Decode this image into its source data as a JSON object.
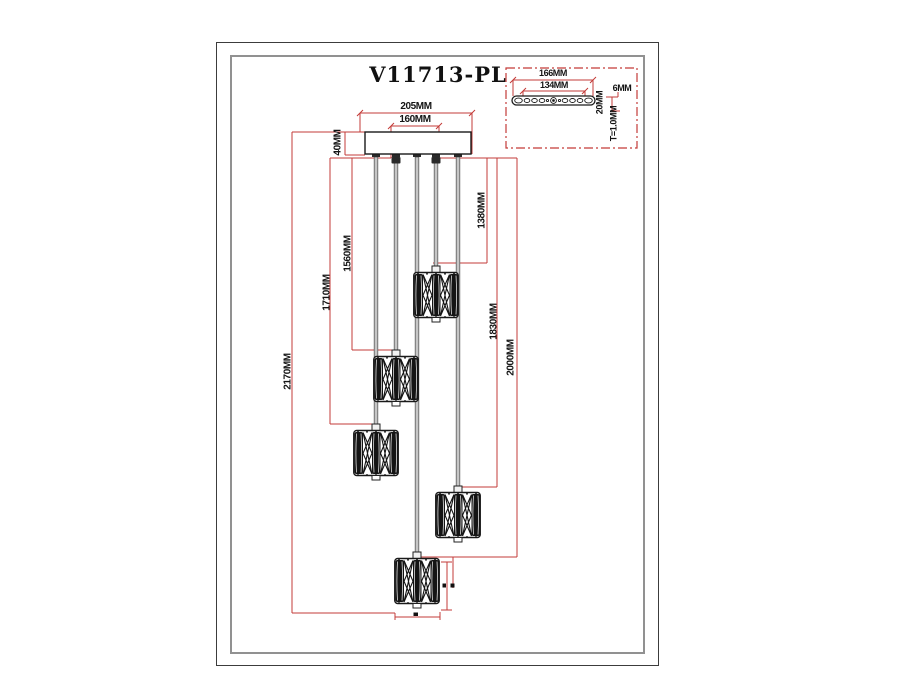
{
  "title": "V11713-PL",
  "colors": {
    "dimension_red": "#c33b38",
    "line_black": "#1a1a1a"
  },
  "canopy": {
    "width_outer": "205MM",
    "width_inner": "160MM",
    "height": "40MM"
  },
  "drop_dimensions": {
    "total": "2170MM",
    "pendant_low_left": "1710MM",
    "pendant_mid_left": "1560MM",
    "pendant_top": "1380MM",
    "pendant_mid_right": "1830MM",
    "pendant_bottom": "2000MM"
  },
  "mount_plate": {
    "width_outer": "166MM",
    "width_inner": "134MM",
    "edge_height": "6MM",
    "depth": "20MM",
    "thickness": "T=1.0MM"
  }
}
